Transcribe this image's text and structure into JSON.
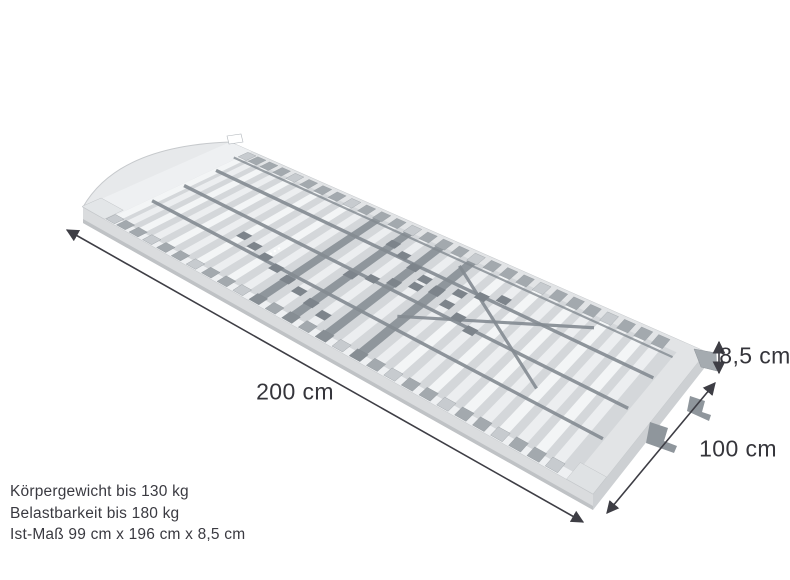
{
  "diagram": {
    "length_label": "200 cm",
    "width_label": "100 cm",
    "height_label": "8,5 cm"
  },
  "specs": {
    "body_weight": "Körpergewicht bis 130 kg",
    "load_capacity": "Belastbarkeit bis 180 kg",
    "actual_size": "Ist-Maß 99 cm x 196 cm x 8,5 cm"
  },
  "illustration": {
    "slat_count": 28,
    "dark_slat_indices": [
      10,
      12,
      14,
      16
    ],
    "colors": {
      "frame_top": "#e7e9eb",
      "frame_edge": "#c6c9cc",
      "frame_side": "#dadcde",
      "frame_side_dark": "#cdd0d3",
      "frame_lip": "#bfc2c5",
      "rail_near": "#eef0f2",
      "rail_far": "#e2e4e6",
      "deck": "#d4d7da",
      "slat_light": "#f3f5f6",
      "slat_alt": "#eceef0",
      "slat_dark": "#8f969c",
      "cap_light": "#c7cbcf",
      "cap_mid": "#a3a9ae",
      "cap_dark": "#878e94",
      "strap": "#848b92",
      "slider": "#7d848b",
      "bracket": "#8f969c",
      "dimension": "#3e3e45",
      "text": "#3a3a41"
    }
  }
}
